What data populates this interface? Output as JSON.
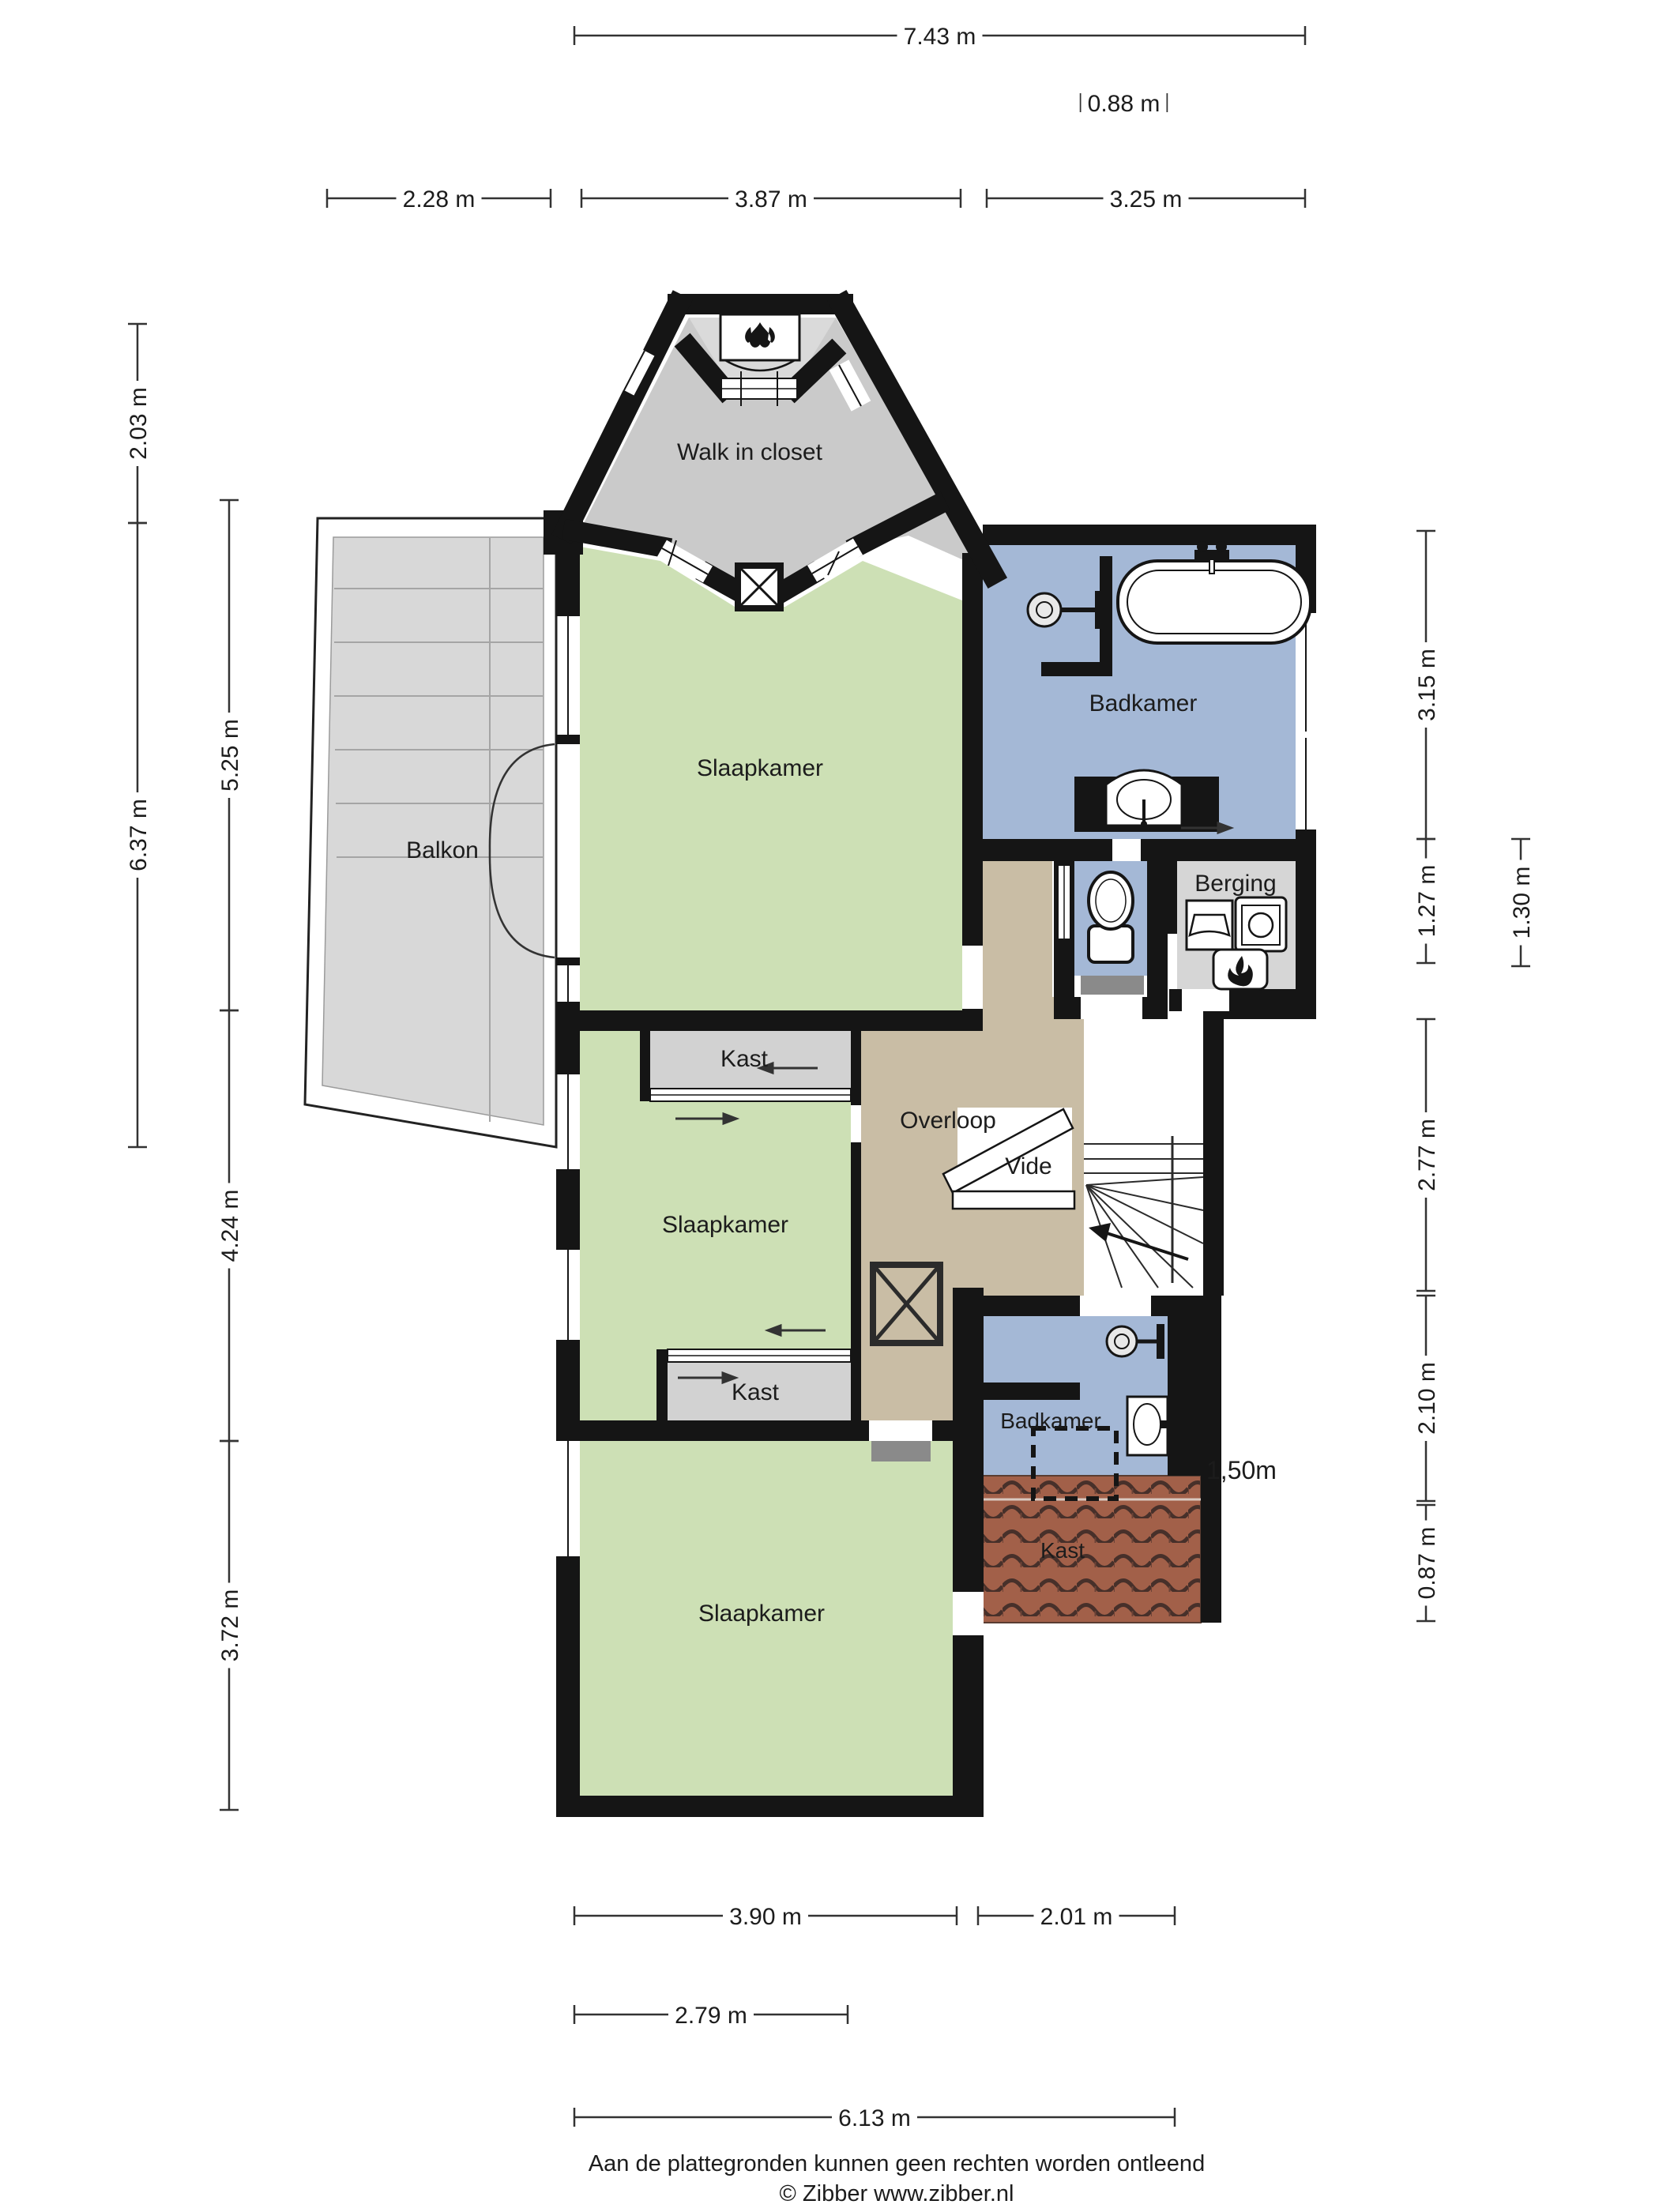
{
  "plan": {
    "rooms": {
      "walk_in_closet": "Walk in closet",
      "slaapkamer_top": "Slaapkamer",
      "badkamer_top": "Badkamer",
      "berging": "Berging",
      "balkon": "Balkon",
      "kast_top": "Kast",
      "slaapkamer_mid": "Slaapkamer",
      "kast_mid": "Kast",
      "overloop": "Overloop",
      "vide": "Vide",
      "slaapkamer_bottom": "Slaapkamer",
      "badkamer_bottom": "Badkamer",
      "kast_roof": "Kast"
    },
    "labels": {
      "headroom": "1,50m"
    },
    "dimensions": {
      "top": [
        "7.43 m",
        "0.88 m",
        "2.28 m",
        "3.87 m",
        "3.25 m"
      ],
      "left": [
        "2.03 m",
        "6.37 m",
        "5.25 m",
        "4.24 m",
        "3.72 m"
      ],
      "right": [
        "3.15 m",
        "1.27 m",
        "1.30 m",
        "2.77 m",
        "2.10 m",
        "0.87 m"
      ],
      "bottom": [
        "3.90 m",
        "2.01 m",
        "2.79 m",
        "6.13 m"
      ]
    },
    "footer": {
      "disclaimer": "Aan de plattegronden kunnen geen rechten worden ontleend",
      "copyright": "© Zibber www.zibber.nl"
    },
    "colors": {
      "wall": "#151515",
      "bedroom_green": "#cde0b5",
      "bathroom_blue": "#a4b8d6",
      "hall_tan": "#c9bda5",
      "closet_gray": "#cacaca",
      "closet_gray_light": "#dadada",
      "balcony_gray": "#d8d8d8",
      "storage_gray": "#d6d6d6",
      "roof_tile_brown": "#a26049",
      "mat_gray": "#8a8a8a"
    },
    "icons": {
      "plant": "plant-icon",
      "bathtub": "bathtub-icon",
      "shower_head": "shower-head-icon",
      "sink": "sink-icon",
      "toilet": "toilet-icon",
      "laundry_sink": "laundry-sink-icon",
      "washing_machine": "washing-machine-icon",
      "boiler_flame": "boiler-flame-icon",
      "stairs_arrow": "stairs-direction-arrow",
      "door_swing": "door-swing-arc",
      "shaft": "shaft-cross-icon",
      "sliding_door_arrow": "sliding-door-arrow"
    }
  }
}
